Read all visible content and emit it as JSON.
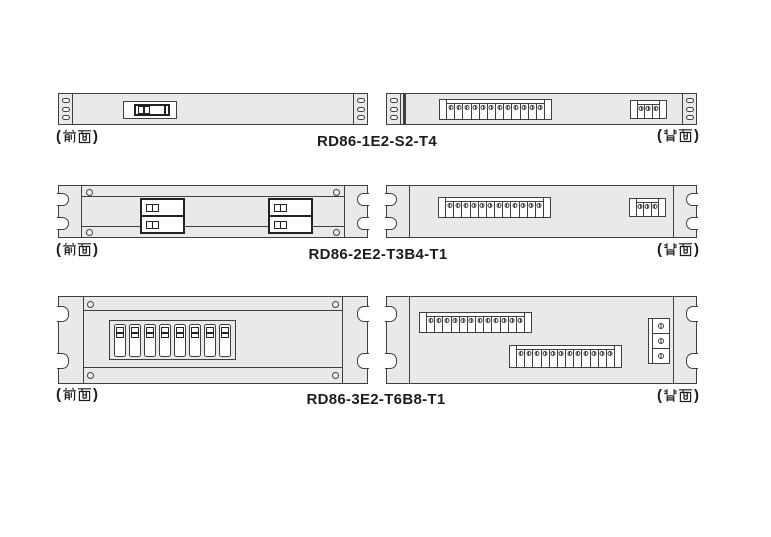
{
  "colors": {
    "background": "#ffffff",
    "panel_fill": "#e9e9e8",
    "outline": "#3f3f3f",
    "dark_line": "#222222",
    "text": "#1d1d1d"
  },
  "glyphs": {
    "open": "(",
    "close": ")"
  },
  "rows": [
    {
      "model": "RD86-1E2-S2-T4",
      "front_label": "(前面)",
      "back_label": "(背面)",
      "front": {
        "ear_holes": 3,
        "switch_modules": 1
      },
      "back": {
        "ear_holes": 3,
        "blocks": [
          {
            "terminals": 12
          },
          {
            "terminals": 3
          }
        ]
      }
    },
    {
      "model": "RD86-2E2-T3B4-T1",
      "front_label": "(前面)",
      "back_label": "(背面)",
      "front": {
        "switch_pairs": 2,
        "switches_per_pair": 2
      },
      "back": {
        "blocks": [
          {
            "terminals": 12
          },
          {
            "terminals": 3
          }
        ]
      }
    },
    {
      "model": "RD86-3E2-T6B8-T1",
      "front_label": "(前面)",
      "back_label": "(背面)",
      "front": {
        "switches": 8
      },
      "back": {
        "blocks": [
          {
            "terminals": 12
          },
          {
            "terminals": 12
          },
          {
            "terminals": 3
          }
        ]
      }
    }
  ]
}
